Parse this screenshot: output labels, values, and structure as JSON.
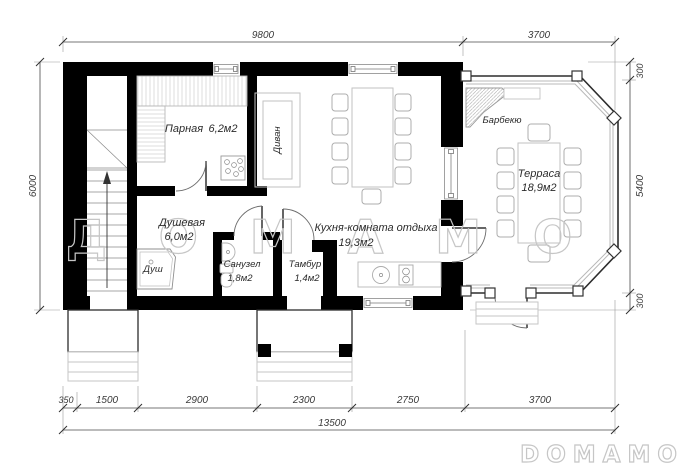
{
  "watermarks": {
    "center": "ДОМАМО",
    "corner": "DOMAMO"
  },
  "rooms": {
    "parnaya": {
      "name": "Парная",
      "area": "6,2м2"
    },
    "dushevaya": {
      "name": "Душевая",
      "area": "6,0м2"
    },
    "sanuzel": {
      "name": "Санузел",
      "area": "1,8м2"
    },
    "tambur": {
      "name": "Тамбур",
      "area": "1,4м2"
    },
    "kitchen": {
      "name": "Кухня-комната отдыха",
      "area": "19,3м2"
    },
    "terrace": {
      "name": "Терраса",
      "area": "18,9м2"
    }
  },
  "furniture": {
    "sofa": "Диван",
    "shower": "Душ",
    "barbecue": "Барбекю"
  },
  "dimensions": {
    "top": {
      "main": "9800",
      "terrace": "3700"
    },
    "left": {
      "height": "6000"
    },
    "right": {
      "top": "300",
      "middle": "5400",
      "bottom": "300"
    },
    "bottom": {
      "segments": [
        "350",
        "1500",
        "2900",
        "2300",
        "2750",
        "3700"
      ],
      "total": "13500"
    }
  },
  "colors": {
    "wall": "#000000",
    "dimension": "#4a4a4a",
    "furniture": "#c2c2c2",
    "watermark": "#c6c6c6"
  }
}
